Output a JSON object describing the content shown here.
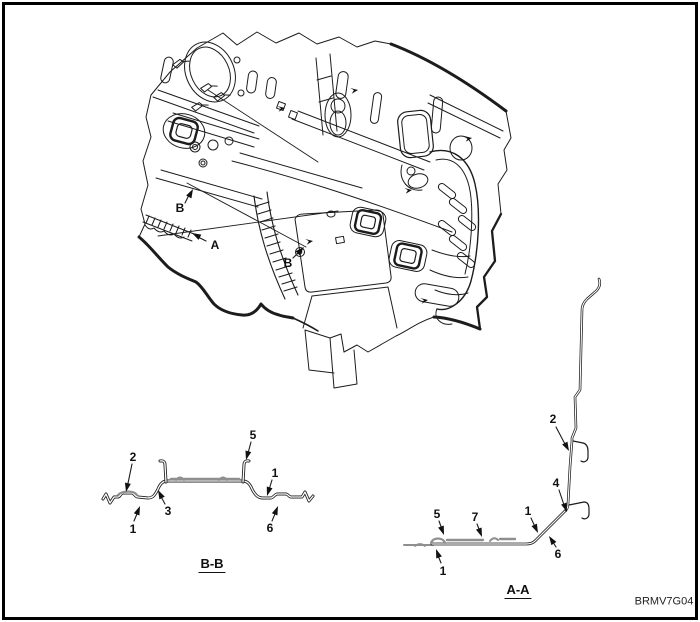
{
  "figure": {
    "code": "BRMV7G04",
    "colors": {
      "line": "#1c1c1c",
      "sealer": "#8f8f8f",
      "background": "#ffffff"
    },
    "main_view": {
      "description": "Isometric cutaway line drawing of rear floor pan and back panel with section cut indicators",
      "section_markers": [
        {
          "label": "B"
        },
        {
          "label": "A"
        },
        {
          "label": "B"
        }
      ]
    },
    "sections": {
      "bb": {
        "title": "B-B",
        "callouts": [
          {
            "n": "2"
          },
          {
            "n": "5"
          },
          {
            "n": "1"
          },
          {
            "n": "3"
          },
          {
            "n": "1"
          },
          {
            "n": "6"
          }
        ]
      },
      "aa": {
        "title": "A-A",
        "callouts": [
          {
            "n": "2"
          },
          {
            "n": "4"
          },
          {
            "n": "1"
          },
          {
            "n": "6"
          },
          {
            "n": "5"
          },
          {
            "n": "7"
          },
          {
            "n": "1"
          }
        ]
      }
    }
  }
}
